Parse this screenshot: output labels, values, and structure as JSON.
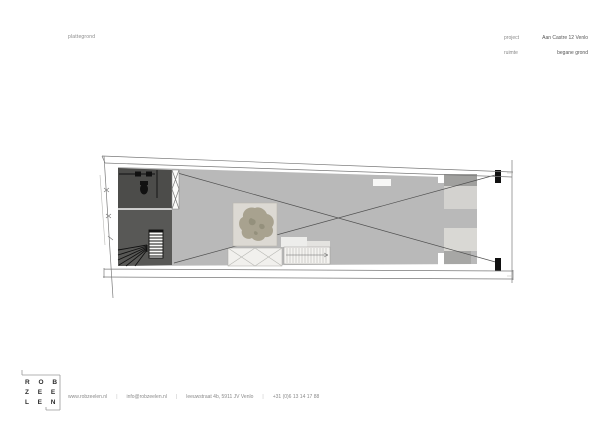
{
  "header": {
    "sheet_label": "plattegrond",
    "project_label": "project",
    "project_value": "Aan Castre 12  Venlo",
    "room_label": "ruimte",
    "room_value": "begane grond"
  },
  "footer": {
    "logo_line1": "R O B",
    "logo_line2": "Z E E",
    "logo_line3": "L E N",
    "separator": "|",
    "contact": [
      "www.robzeelen.nl",
      "info@robzeelen.nl",
      "leeuwstraat 4b, 5911 JV Venlo",
      "+31 (0)6 13 14 17 88"
    ]
  },
  "colors": {
    "page_bg": "#ffffff",
    "floor_gray": "#b9b9b9",
    "dark_room": "#4c4c4a",
    "dark_room_lower": "#585856",
    "patio": "#dcd9d3",
    "tree": "#a49f8b",
    "line": "#7a7a7a",
    "ink": "#111111",
    "text_gray": "#8a8a8a"
  }
}
